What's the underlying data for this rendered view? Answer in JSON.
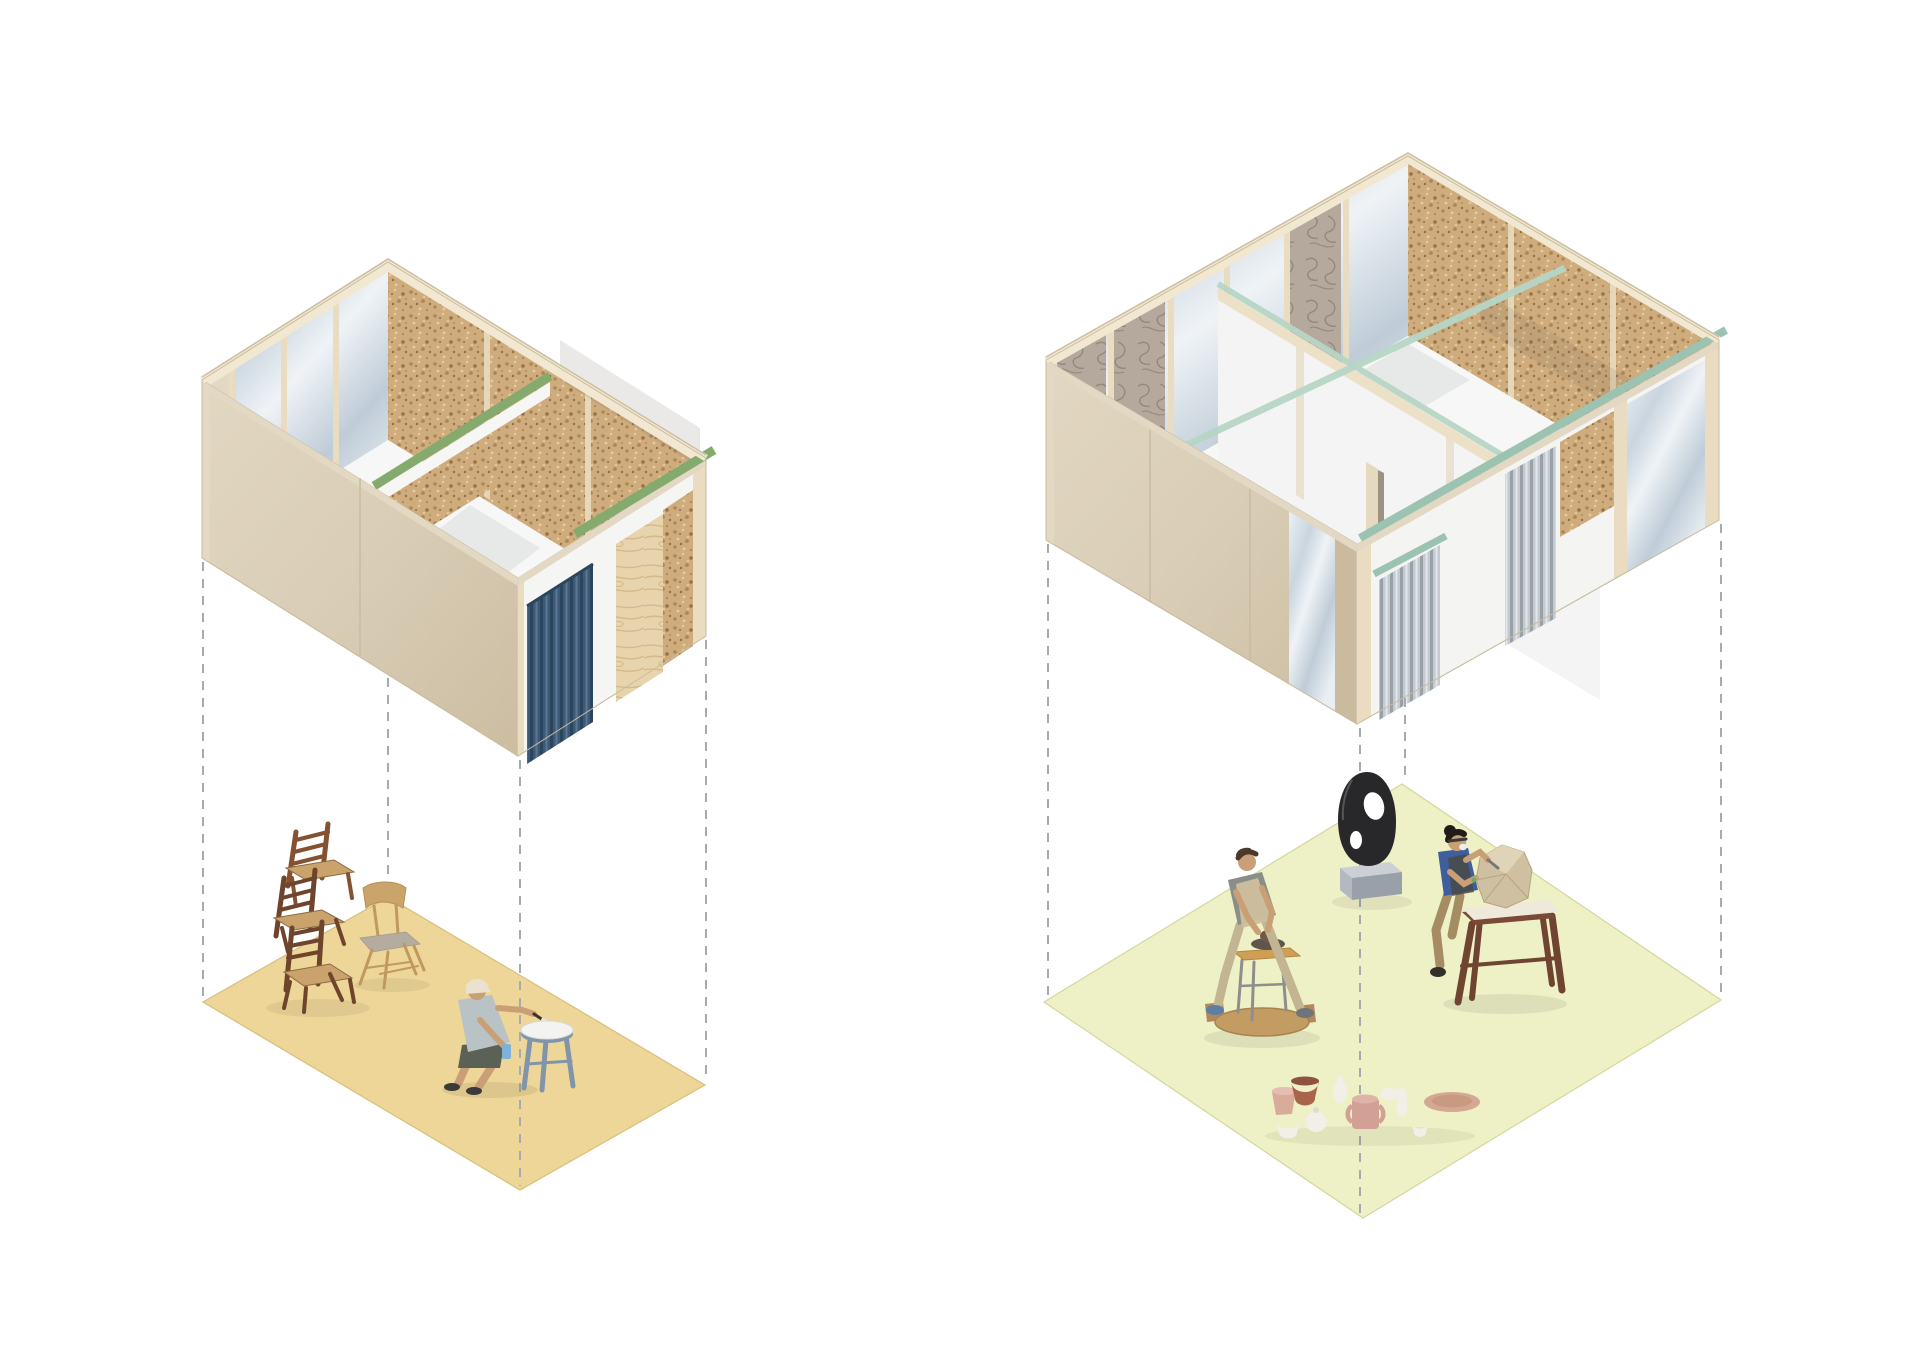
{
  "scene": {
    "composition": "two axonometric studio units floating above exploded floor planes joined by vertical dashed projection lines",
    "units": [
      {
        "id": "small-studio",
        "position": "left",
        "building": {
          "exterior": "plain plywood panel walls",
          "interior_walls": [
            "translucent polycarbonate panels with timber studs",
            "cork pinboard panels with timber studs"
          ],
          "top_beam_color_ref": "green_beam",
          "roller_door": "blue corrugated roller door",
          "door_panel": "plywood leaf with grain",
          "partition": "internal cork partition with green top plate"
        },
        "floor": {
          "color_ref": "floor_left",
          "contents": [
            "stack of three dark wooden chairs",
            "light wooden chair",
            "crouching person painting a stool",
            "blue-grey stool with white top",
            "paintbrush",
            "blue spray bottle"
          ]
        },
        "projection_lines": 4
      },
      {
        "id": "large-studio",
        "position": "right",
        "building": {
          "exterior": "plain plywood panel walls with one translucent bay",
          "interior_walls": [
            "translucent polycarbonate panels with timber studs",
            "cork pinboard panels",
            "swirl-grain plywood panels"
          ],
          "top_beam_color_ref": "teal_beam",
          "partition": "internal white partition with doorway and seafoam glass top beam",
          "curtains": "grey corrugated hanging panels"
        },
        "floor": {
          "color_ref": "floor_right",
          "contents": [
            "potter shaping clay at a pottery wheel on round wooden base",
            "black abstract sculpture with two holes on a grey plinth",
            "sculptor carving a stone block on a dark wooden bench",
            "group of ceramic vessels: bowls, jars, jugs, vase and plate"
          ]
        },
        "projection_lines": 4
      }
    ],
    "projection_style": {
      "stroke_ref": "dash",
      "dash_pattern": "9 8"
    }
  },
  "colors": {
    "background": "#ffffff",
    "wood_frame": "#f2e8d2",
    "wood_edge": "#cdbfa3",
    "wall_beige_light": "#e3d8c3",
    "wall_beige": "#d9cdb6",
    "wall_beige_dark": "#cabb9f",
    "stud": "#e9dcc0",
    "cork_base": "#cfac7e",
    "cork_speck_dark": "#ad8655",
    "cork_speck_light": "#e6cc9c",
    "cork_speck_deep": "#97703f",
    "poly_light": "#eef3f7",
    "poly_mid": "#c9d5df",
    "poly_deep": "#b9c7d3",
    "marble_base": "#b5a99d",
    "marble_swirl": "#8b7f74",
    "green_beam": "#84ab6d",
    "teal_beam": "#9cc2b1",
    "glass_beam": "#b7d6c6",
    "blue_door": "#3c5a76",
    "blue_door_dark": "#2c455f",
    "blue_door_light": "#5a7896",
    "grey_corr": "#c4cacf",
    "grey_corr_dark": "#99a1a8",
    "grey_corr_light": "#e2e6e9",
    "ply_leaf": "#e8d4ac",
    "ply_grain": "#cfb181",
    "floor_left": "#edd697",
    "floor_left_edge": "#d8bf7c",
    "floor_right": "#eef0c6",
    "floor_right_edge": "#d4d79e",
    "dash": "#a6abad",
    "interior_white": "#f6f7f6",
    "shadow_grey": "#8d9296",
    "chair_dark": "#6e452c",
    "chair_dark2": "#845231",
    "chair_seat": "#c9a36b",
    "chair_light_wood": "#c9a56c",
    "chair_light_seat": "#b5aca0",
    "skin": "#c99f76",
    "painter_shirt": "#b9c3c6",
    "painter_shorts": "#5c6156",
    "painter_cap": "#e9e2d0",
    "stool_blue": "#8195aa",
    "stool_top": "#f3f4f2",
    "bottle_blue": "#7fb2d8",
    "potter_shirt": "#8a8e89",
    "potter_apron": "#cdbf9d",
    "potter_pants": "#c3b492",
    "potter_hair": "#4a382b",
    "wheel_wood": "#c29c63",
    "wheel_wood_dark": "#a8834f",
    "wheel_table": "#cf9f55",
    "wheel_metal": "#8e8e8a",
    "clay": "#6d5a4a",
    "sculptor_shirt": "#3f5e9e",
    "sculptor_pants": "#a58c63",
    "sculptor_hair": "#221c18",
    "bench_wood": "#6f4431",
    "stone": "#cfc0a2",
    "stone_light": "#e0d4b8",
    "paper": "#efe9dc",
    "sculpture_black": "#28282a",
    "plinth_top": "#ccd0d6",
    "plinth_front": "#9aa0a9",
    "plinth_side": "#b4b9c1",
    "cer_white": "#f1efe8",
    "cer_pink": "#d8ab9b",
    "cer_rose": "#d3a096",
    "cer_terra": "#a9654c",
    "cer_plate": "#d4a894",
    "shoe_dark": "#3a3a38",
    "shoe_blue": "#5b7ea6"
  }
}
